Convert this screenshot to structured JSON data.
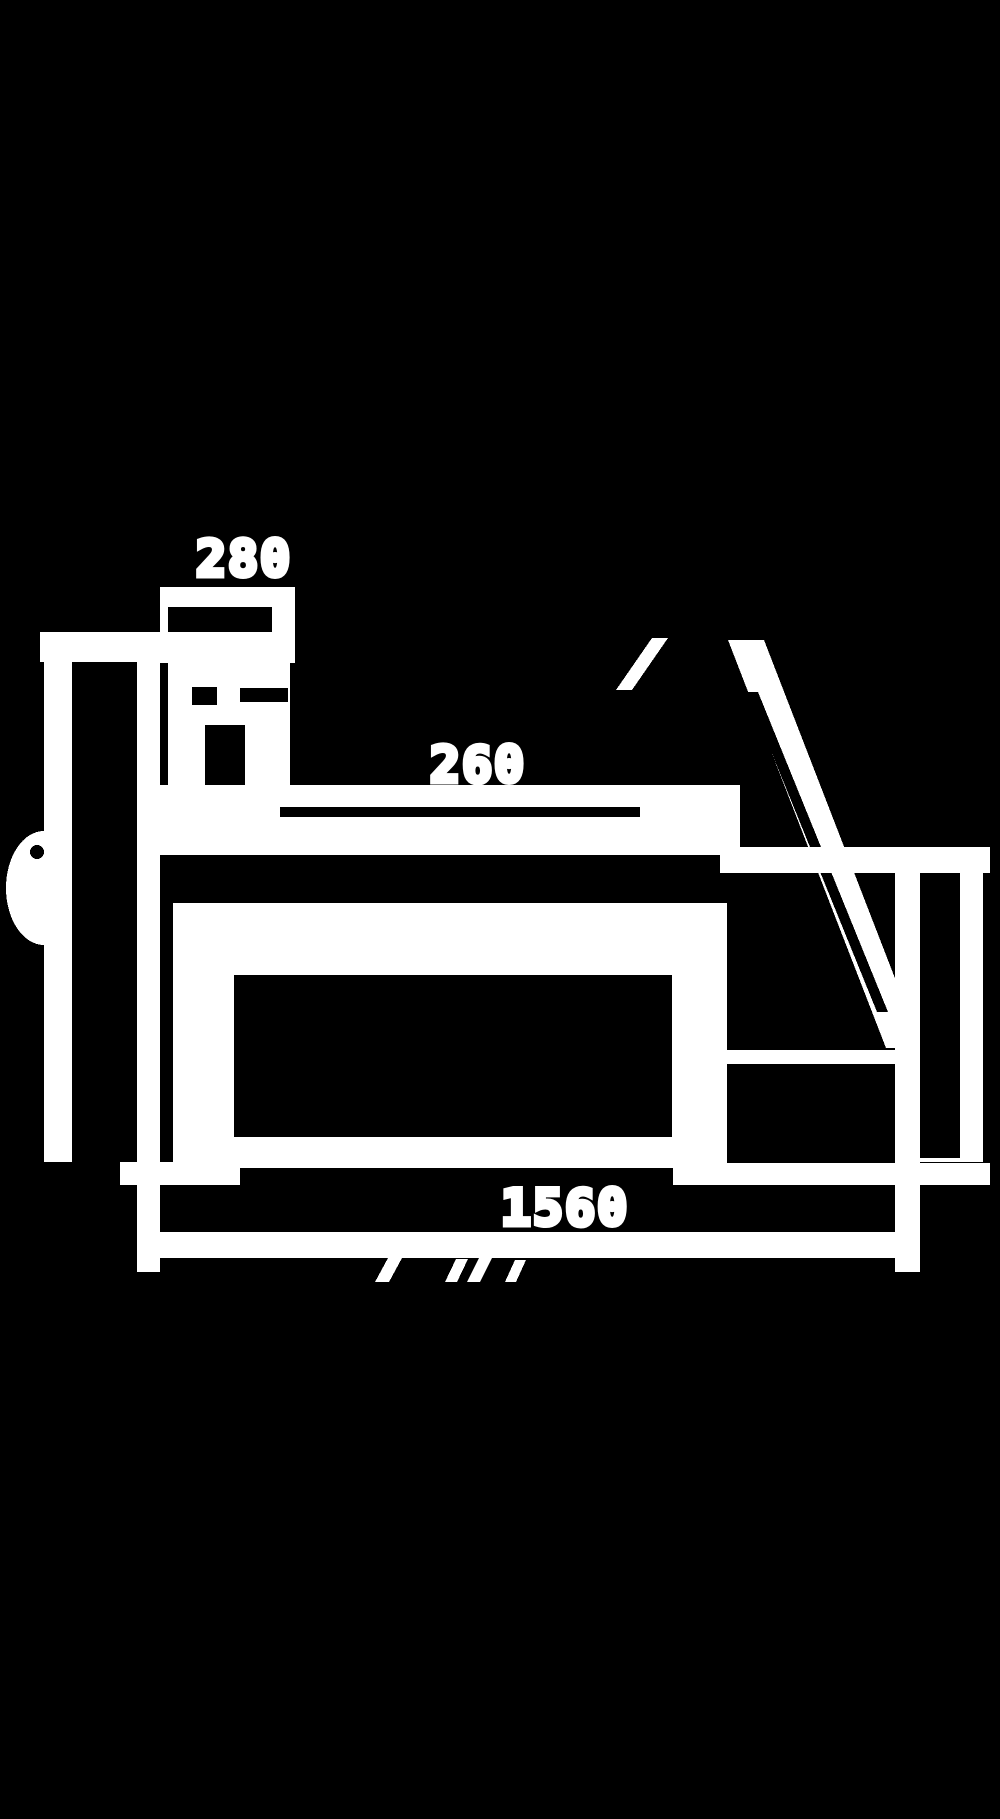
{
  "page": {
    "title": "machine side elevation drawing",
    "background_color": "#000000",
    "ink_color": "#ffffff",
    "width": 1000,
    "height": 1819
  },
  "diagram": {
    "description": "Pixelated white-on-black dimensioned side-view technical drawing of a bench machine: left leg with hand knob, control box labelled 280, flat table top, body box, inclined support strut to a right leg, and an overall length dimension line of 1560",
    "labels": [
      {
        "id": "dim-280",
        "text": "280",
        "x": 244,
        "y": 559,
        "font_size": 50
      },
      {
        "id": "dim-260",
        "text": "260",
        "x": 478,
        "y": 765,
        "font_size": 50
      },
      {
        "id": "dim-1560",
        "text": "1560",
        "x": 565,
        "y": 1208,
        "font_size": 50
      }
    ],
    "shapes": [
      {
        "name": "headboard-top-band",
        "kind": "rect",
        "fill": "ink",
        "x": 40,
        "y": 632,
        "w": 150,
        "h": 30
      },
      {
        "name": "side-knob",
        "kind": "ellipse",
        "fill": "ink",
        "cx": 44,
        "cy": 888,
        "rx": 38,
        "ry": 57
      },
      {
        "name": "left-leg-left-edge",
        "kind": "rect",
        "fill": "ink",
        "x": 44,
        "y": 632,
        "w": 28,
        "h": 530
      },
      {
        "name": "left-leg-right-edge",
        "kind": "rect",
        "fill": "ink",
        "x": 137,
        "y": 632,
        "w": 23,
        "h": 530
      },
      {
        "name": "left-leg-interior",
        "kind": "rect",
        "fill": "bg",
        "x": 72,
        "y": 662,
        "w": 65,
        "h": 500
      },
      {
        "name": "knob-hole",
        "kind": "circle",
        "fill": "bg",
        "cx": 37,
        "cy": 852,
        "r": 7
      },
      {
        "name": "control-box",
        "kind": "rect",
        "fill": "ink",
        "x": 160,
        "y": 587,
        "w": 135,
        "h": 76
      },
      {
        "name": "control-box-inner",
        "kind": "rect",
        "fill": "bg",
        "x": 168,
        "y": 607,
        "w": 104,
        "h": 25
      },
      {
        "name": "bracket",
        "kind": "rect",
        "fill": "ink",
        "x": 168,
        "y": 663,
        "w": 122,
        "h": 134
      },
      {
        "name": "bracket-hole-left",
        "kind": "rect",
        "fill": "bg",
        "x": 192,
        "y": 687,
        "w": 25,
        "h": 18
      },
      {
        "name": "bracket-hole-right",
        "kind": "rect",
        "fill": "bg",
        "x": 240,
        "y": 688,
        "w": 48,
        "h": 14
      },
      {
        "name": "bracket-slot",
        "kind": "rect",
        "fill": "bg",
        "x": 205,
        "y": 725,
        "w": 40,
        "h": 65
      },
      {
        "name": "table-top",
        "kind": "rect",
        "fill": "ink",
        "x": 160,
        "y": 785,
        "w": 580,
        "h": 70
      },
      {
        "name": "table-slit",
        "kind": "rect",
        "fill": "bg",
        "x": 280,
        "y": 807,
        "w": 360,
        "h": 10
      },
      {
        "name": "body-box",
        "kind": "rect",
        "fill": "ink",
        "x": 173,
        "y": 903,
        "w": 554,
        "h": 265
      },
      {
        "name": "body-box-inner",
        "kind": "rect",
        "fill": "bg",
        "x": 234,
        "y": 975,
        "w": 438,
        "h": 162
      },
      {
        "name": "support-strut",
        "kind": "polygon",
        "fill": "ink",
        "points": "728,640 764,640 922,1048 886,1048"
      },
      {
        "name": "strut-inner-line",
        "kind": "polygon",
        "fill": "bg",
        "points": "747,692 758,692 888,1012 877,1012"
      },
      {
        "name": "strut-upper-tick",
        "kind": "polygon",
        "fill": "ink",
        "points": "616,690 632,690 668,638 652,638"
      },
      {
        "name": "right-shelf",
        "kind": "rect",
        "fill": "ink",
        "x": 720,
        "y": 847,
        "w": 270,
        "h": 26
      },
      {
        "name": "horizontal-member",
        "kind": "rect",
        "fill": "ink",
        "x": 727,
        "y": 1050,
        "w": 170,
        "h": 14
      },
      {
        "name": "right-leg",
        "kind": "rect",
        "fill": "ink",
        "x": 895,
        "y": 873,
        "w": 88,
        "h": 289
      },
      {
        "name": "right-leg-inner",
        "kind": "rect",
        "fill": "bg",
        "x": 920,
        "y": 873,
        "w": 40,
        "h": 285
      },
      {
        "name": "left-foot",
        "kind": "rect",
        "fill": "ink",
        "x": 120,
        "y": 1162,
        "w": 120,
        "h": 23
      },
      {
        "name": "right-foot",
        "kind": "rect",
        "fill": "ink",
        "x": 673,
        "y": 1163,
        "w": 317,
        "h": 22
      },
      {
        "name": "extension-line-left",
        "kind": "rect",
        "fill": "ink",
        "x": 137,
        "y": 1160,
        "w": 23,
        "h": 112
      },
      {
        "name": "extension-line-right",
        "kind": "rect",
        "fill": "ink",
        "x": 895,
        "y": 1064,
        "w": 25,
        "h": 208
      },
      {
        "name": "dimension-line",
        "kind": "rect",
        "fill": "ink",
        "x": 160,
        "y": 1232,
        "w": 760,
        "h": 26
      },
      {
        "name": "dim-tick-1",
        "kind": "polygon",
        "fill": "ink",
        "points": "375,1282 389,1282 402,1258 388,1258"
      },
      {
        "name": "dim-tick-2",
        "kind": "polygon",
        "fill": "ink",
        "points": "445,1282 457,1282 468,1259 456,1259"
      },
      {
        "name": "dim-tick-3",
        "kind": "polygon",
        "fill": "ink",
        "points": "467,1282 480,1282 492,1258 479,1258"
      },
      {
        "name": "dim-tick-4",
        "kind": "polygon",
        "fill": "ink",
        "points": "505,1282 516,1282 526,1260 515,1260"
      }
    ]
  }
}
